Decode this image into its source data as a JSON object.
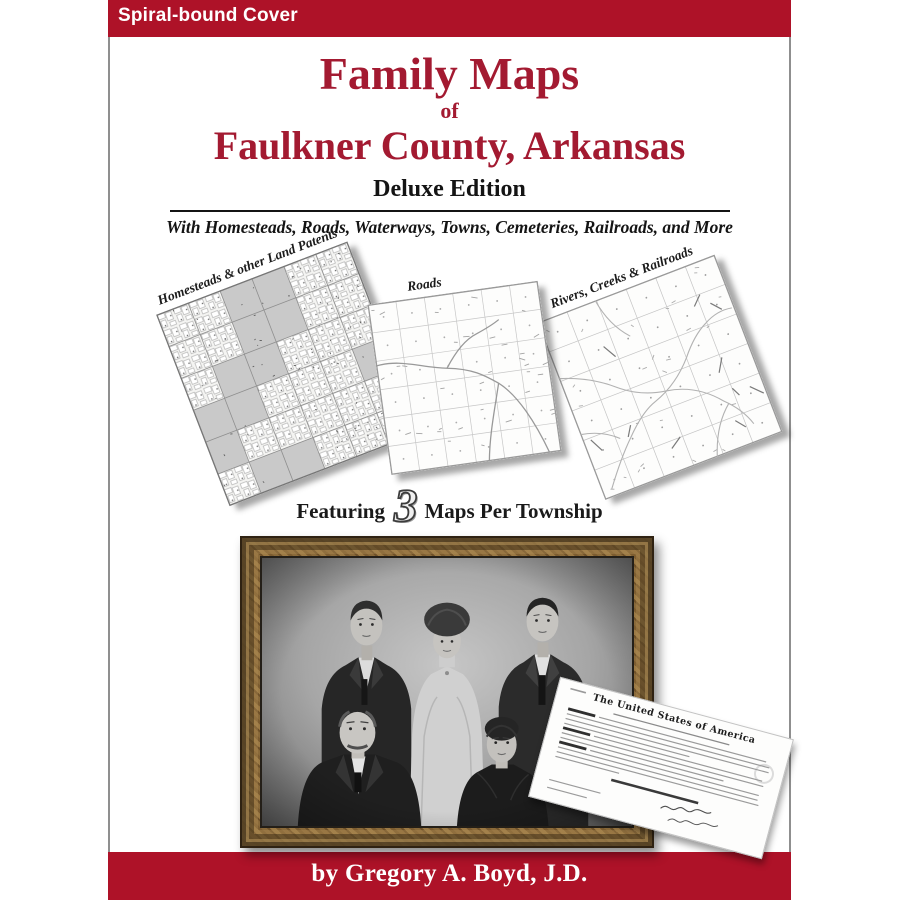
{
  "banner": {
    "label": "Spiral-bound Cover"
  },
  "title": {
    "line1": "Family Maps",
    "connector": "of",
    "line2": "Faulkner County, Arkansas",
    "edition": "Deluxe Edition",
    "subtitle": "With Homesteads, Roads, Waterways, Towns, Cemeteries, Railroads, and More"
  },
  "maps": [
    {
      "id": "homesteads",
      "label": "Homesteads & other Land Patents"
    },
    {
      "id": "roads",
      "label": "Roads"
    },
    {
      "id": "rivers",
      "label": "Rivers, Creeks & Railroads"
    }
  ],
  "tagline": {
    "featuring": "Featuring",
    "number": "3",
    "rest": "Maps Per Township"
  },
  "document": {
    "title": "The United States of America"
  },
  "author": {
    "byline": "by Gregory A. Boyd, J.D."
  },
  "colors": {
    "bar_crimson": "#ae1228",
    "title_red": "#a31a31",
    "side_border_gray": "#8f8f8f",
    "map_shade_gray": "#c9c9c9"
  }
}
